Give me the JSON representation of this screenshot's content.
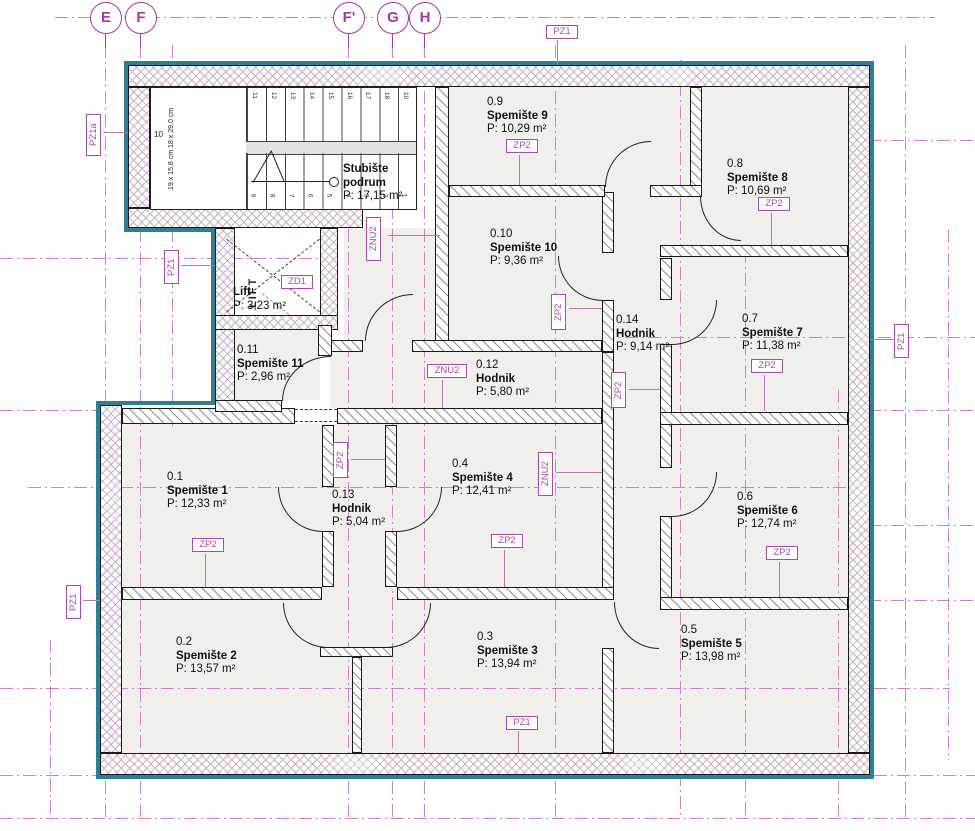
{
  "axes": [
    {
      "label": "E"
    },
    {
      "label": "F"
    },
    {
      "label": "F'"
    },
    {
      "label": "G"
    },
    {
      "label": "H"
    }
  ],
  "rooms": [
    {
      "id": "0.1",
      "name": "Spemište 1",
      "area": "P: 12,33 m²"
    },
    {
      "id": "0.2",
      "name": "Spemište 2",
      "area": "P: 13,57 m²"
    },
    {
      "id": "0.3",
      "name": "Spemište 3",
      "area": "P: 13,94 m²"
    },
    {
      "id": "0.4",
      "name": "Spemište 4",
      "area": "P: 12,41 m²"
    },
    {
      "id": "0.5",
      "name": "Spemište 5",
      "area": "P: 13,98 m²"
    },
    {
      "id": "0.6",
      "name": "Spemište 6",
      "area": "P: 12,74 m²"
    },
    {
      "id": "0.7",
      "name": "Spemište 7",
      "area": "P: 11,38 m²"
    },
    {
      "id": "0.8",
      "name": "Spemište 8",
      "area": "P: 10,69 m²"
    },
    {
      "id": "0.9",
      "name": "Spemište 9",
      "area": "P: 10,29 m²"
    },
    {
      "id": "0.10",
      "name": "Spemište 10",
      "area": "P: 9,36 m²"
    },
    {
      "id": "0.11",
      "name": "Spemište 11",
      "area": "P: 2,96 m²"
    },
    {
      "id": "0.12",
      "name": "Hodnik",
      "area": "P: 5,80 m²"
    },
    {
      "id": "0.13",
      "name": "Hodnik",
      "area": "P: 5,04 m²"
    },
    {
      "id": "0.14",
      "name": "Hodnik",
      "area": "P: 9,14 m²"
    }
  ],
  "lift": {
    "label": "Lift",
    "area": "P: 3,23 m²",
    "shaft_text": "LIFT"
  },
  "stairs": {
    "title_line1": "Stubište",
    "title_line2": "podrum",
    "area": "P: 17,15 m²",
    "riser_dim": "19 x 15,8 cm",
    "tread_dim": "18 x 29,0 cm",
    "landing_number": "10",
    "upper_flight_numbers": [
      "11",
      "12",
      "13",
      "14",
      "15",
      "16",
      "17",
      "18",
      "19"
    ],
    "lower_flight_numbers": [
      "9",
      "8",
      "7",
      "6",
      "5",
      "4",
      "3",
      "2",
      "1"
    ]
  },
  "tags": {
    "pz1": "PZ1",
    "pz1a": "PZ1a",
    "zp2": "ZP2",
    "znu2": "ZNU2",
    "zd1": "ZD1"
  },
  "colors": {
    "accent_purple": "#9C3D9C",
    "grid_magenta": "#CB82CB",
    "teal_outline": "#2E7F93",
    "wall_dark": "#1a1a1a"
  }
}
